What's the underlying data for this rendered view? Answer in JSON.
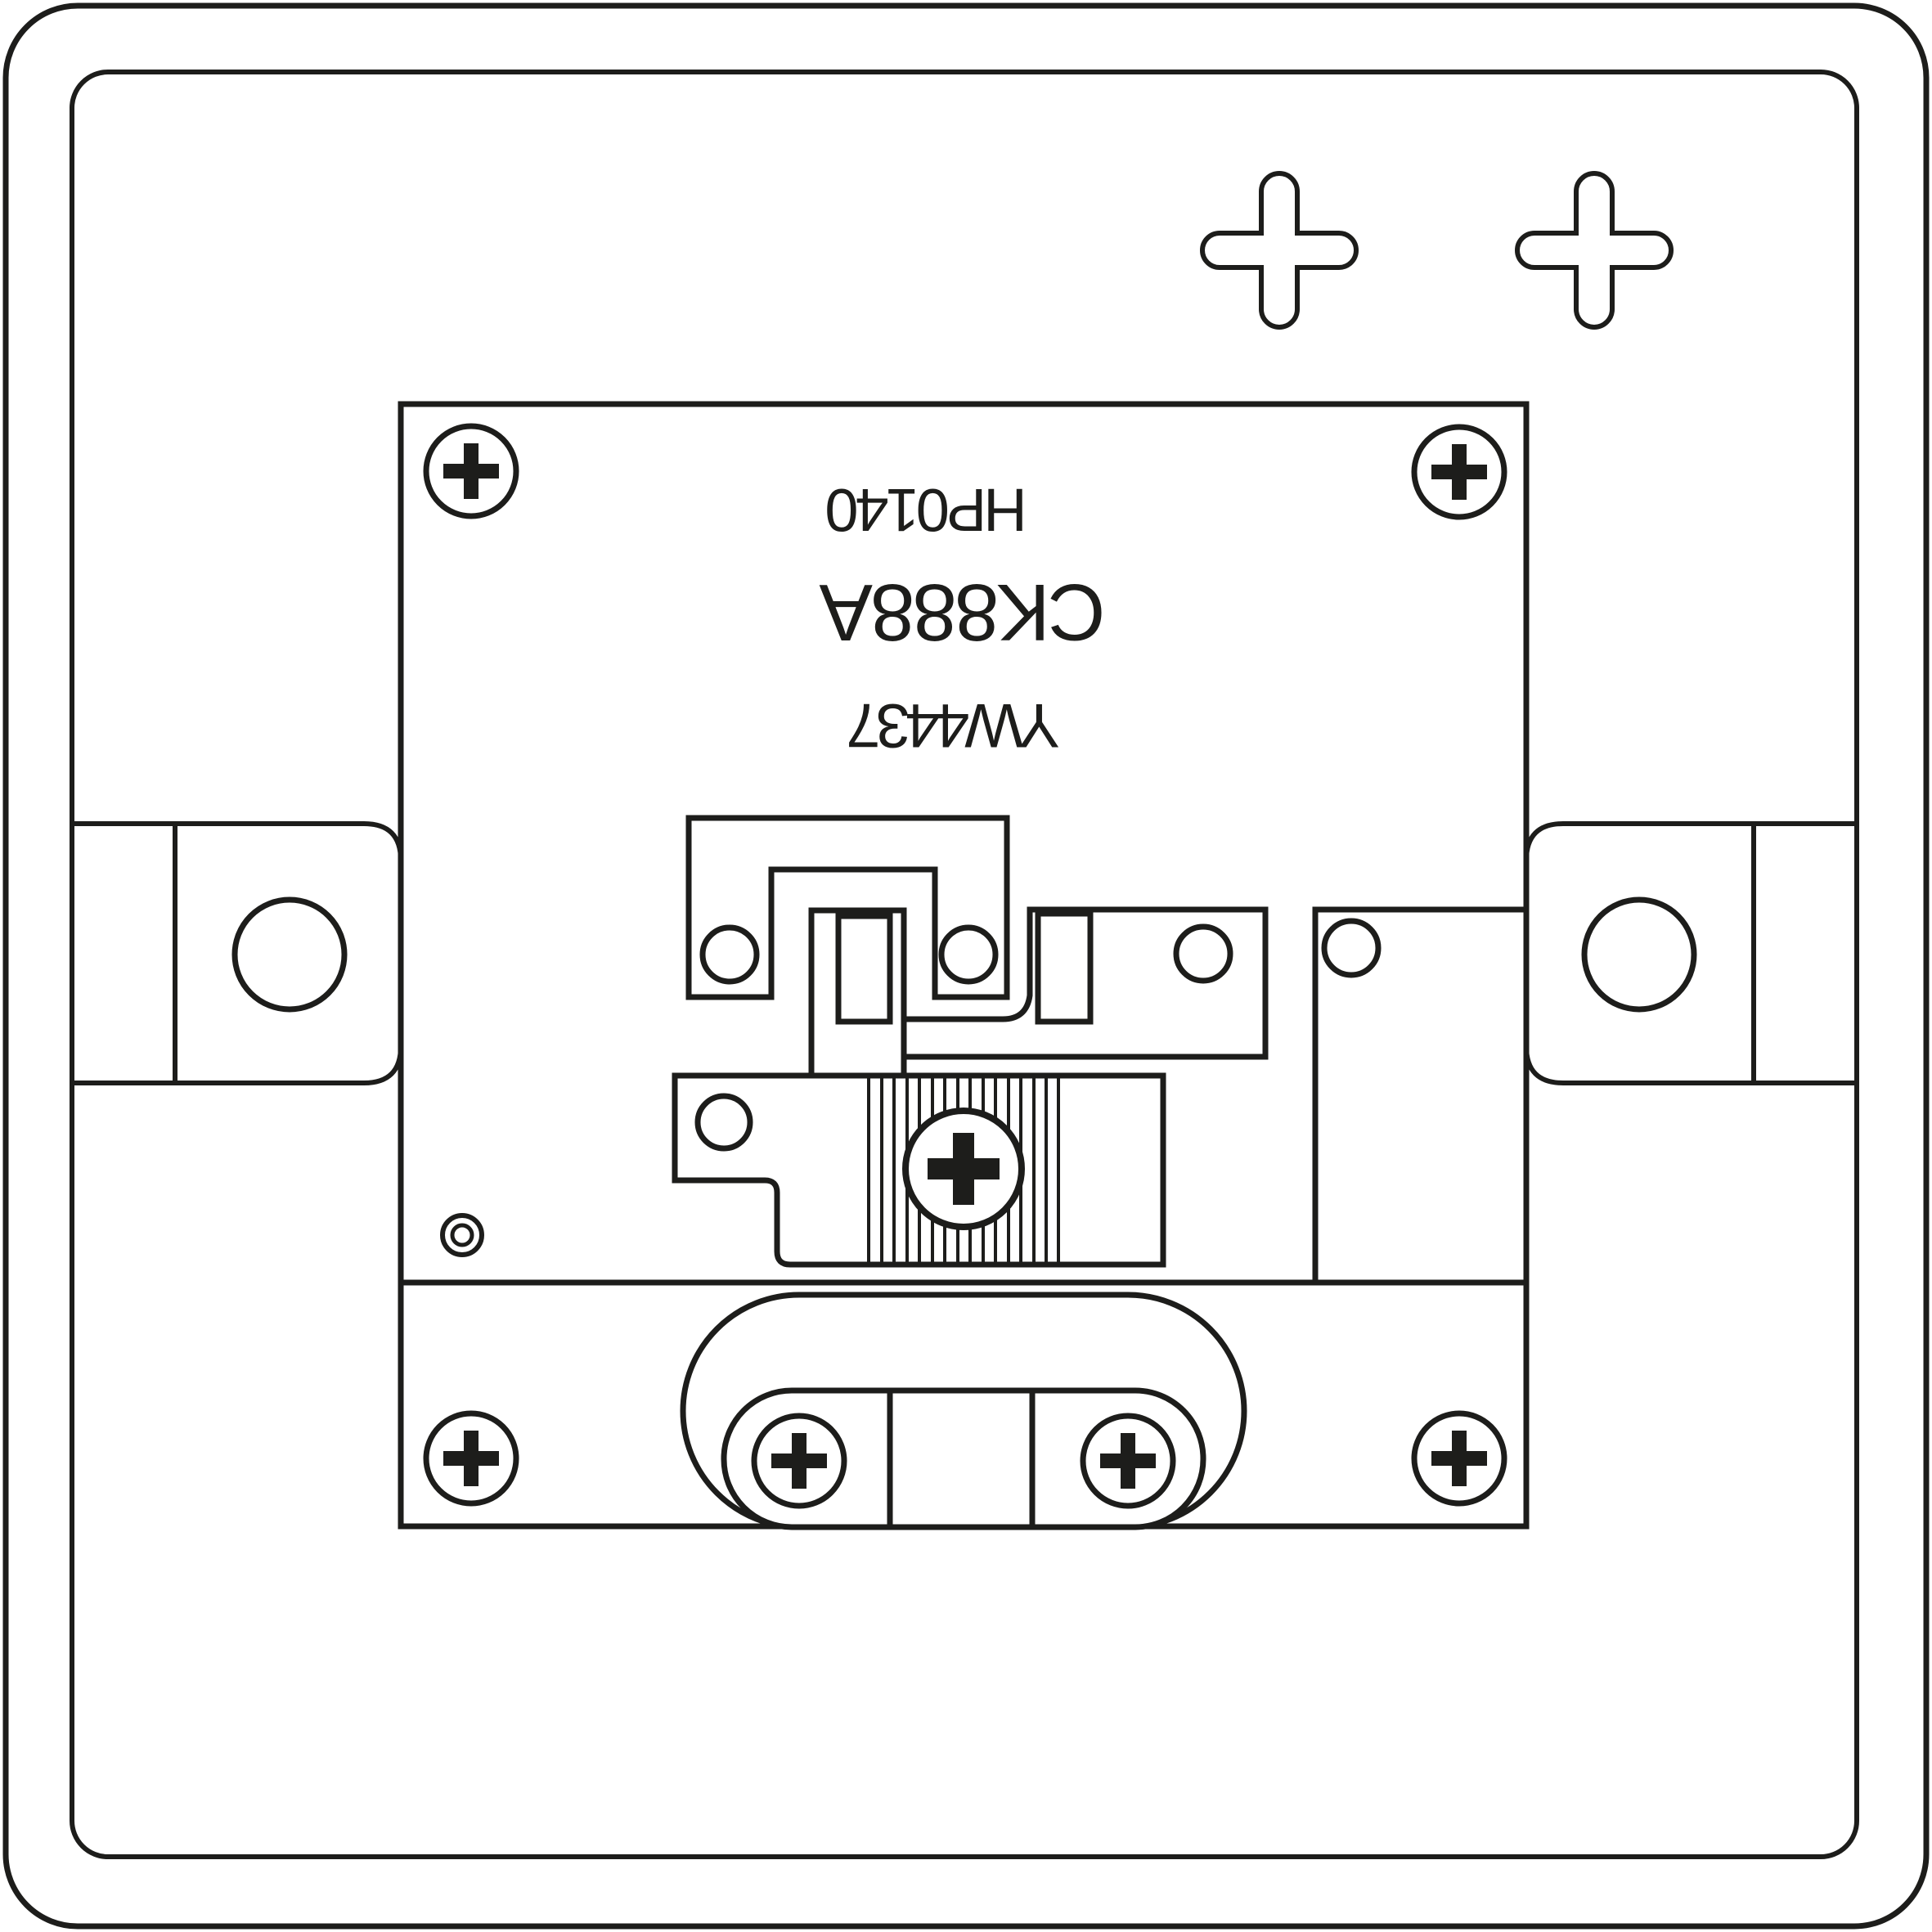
{
  "page": {
    "background_color": "#ffffff",
    "line_color": "#1d1d1b"
  },
  "diagram": {
    "type": "technical-line-drawing",
    "subject": "rear view of a single-gang wall switch plate",
    "orientation_of_text": "rotated 180 degrees (upside down)",
    "labels": {
      "print_code": "HP0140",
      "model_code": "CK888A",
      "batch_code": "YW4437"
    },
    "components": [
      "wall-plate-outline",
      "plate-face-inner-edge",
      "keyhole-cross-cutout",
      "mounting-lug-left",
      "mounting-lug-right",
      "lug-hole",
      "mounting-frame",
      "phillips-screw",
      "switch-bridge-plate",
      "contact-link",
      "terminal-plate",
      "terminal-plate-right",
      "cam-plate",
      "knurled-adjuster-screw",
      "pilot-hole-ring",
      "cable-boss-outer",
      "cable-boss-inner",
      "cable-clamp-block"
    ]
  }
}
